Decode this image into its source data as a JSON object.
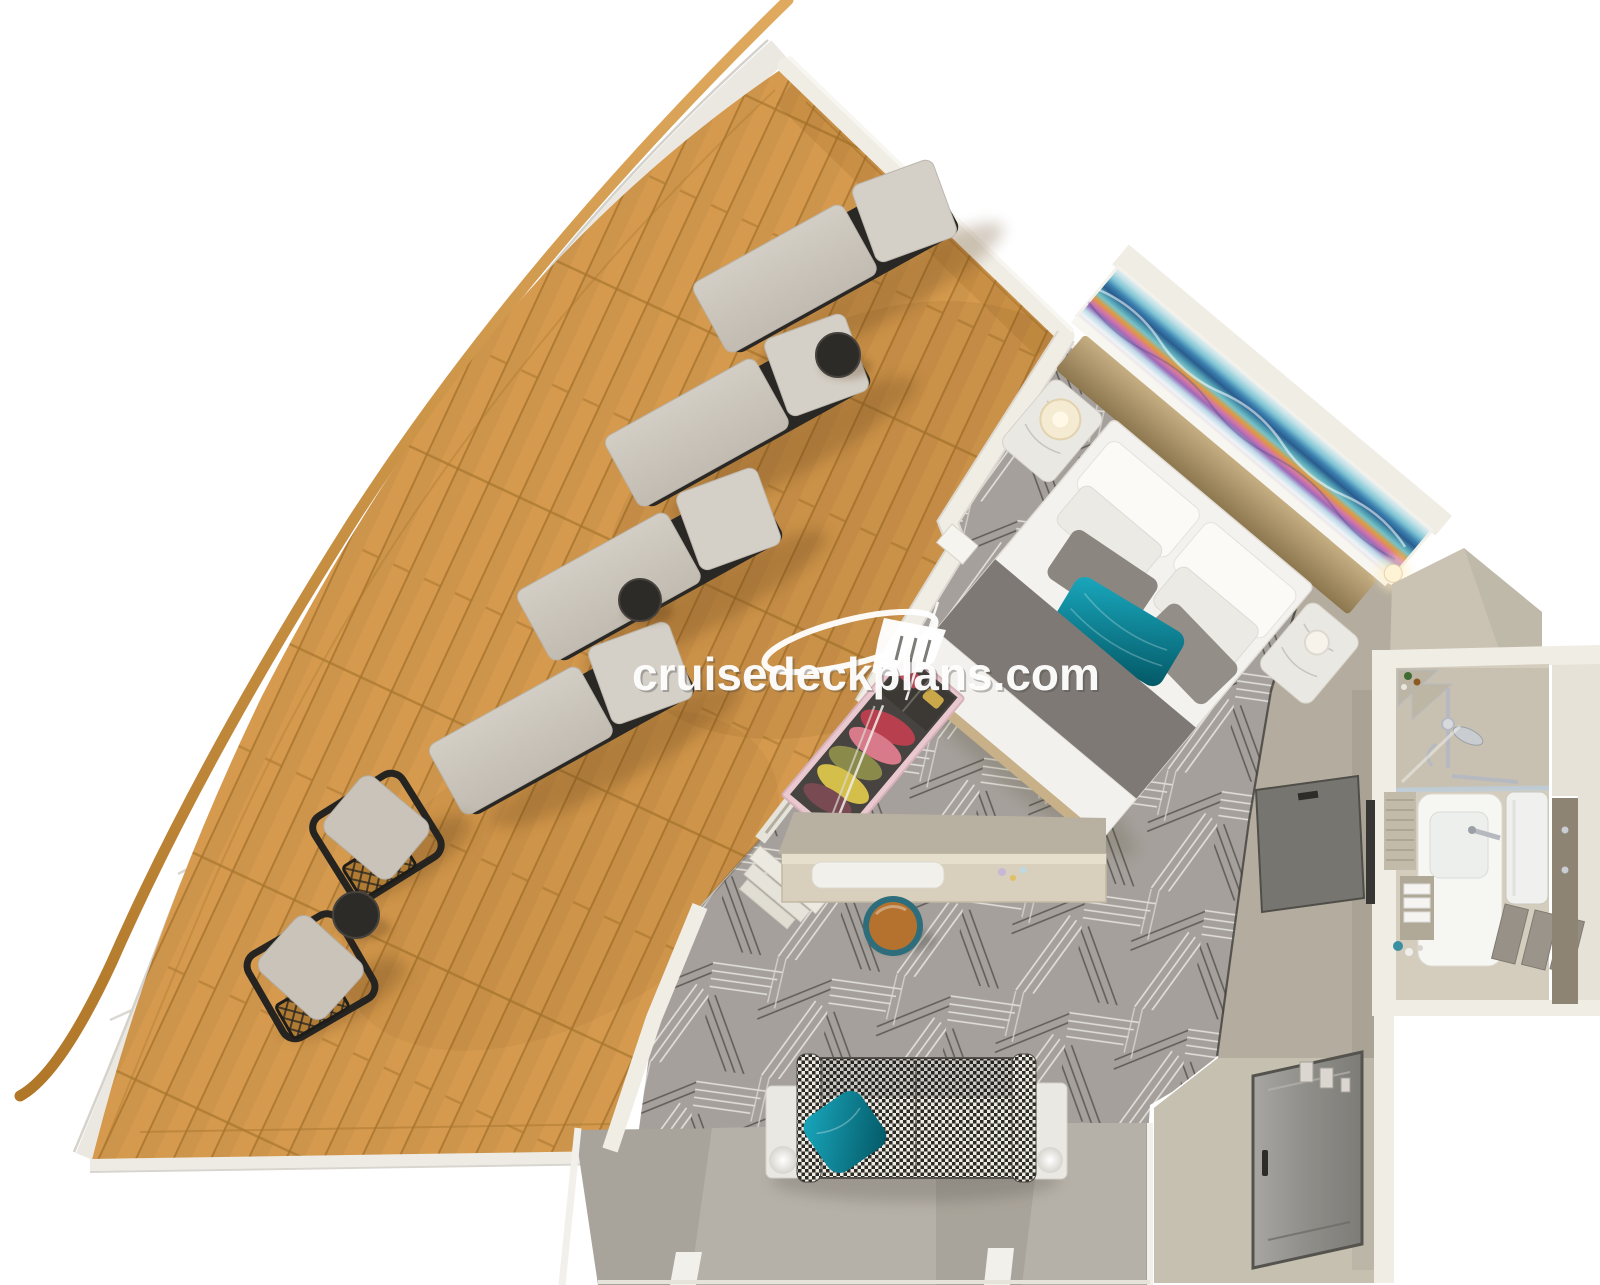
{
  "diagram": {
    "type": "cruise-cabin-3d-floorplan",
    "view": "top-down cutaway render",
    "rooms": [
      {
        "name": "balcony",
        "floor": "teak-plank-deck",
        "furniture": [
          "sun-lounger",
          "sun-lounger",
          "sun-lounger",
          "sun-lounger",
          "round-side-table",
          "round-side-table",
          "rattan-chair",
          "rattan-chair",
          "round-side-table"
        ]
      },
      {
        "name": "bedroom",
        "floor": "geometric-gray-carpet",
        "furniture": [
          "queen-bed",
          "headboard-art-panel",
          "nightstand-with-lamp",
          "nightstand-with-lamp",
          "wall-sconce",
          "open-wardrobe",
          "vanity-desk",
          "round-stool"
        ]
      },
      {
        "name": "sitting-area",
        "floor": "geometric-gray-carpet",
        "furniture": [
          "houndstooth-sofa",
          "teal-accent-pillow",
          "marble-lamp-table",
          "marble-lamp-table"
        ]
      },
      {
        "name": "bathroom",
        "floor": "vinyl",
        "fixtures": [
          "shower",
          "glass-partition",
          "vanity-sink",
          "mirror",
          "louver-cabinet",
          "towel-shelf",
          "towel-rack",
          "tall-cabinet"
        ]
      },
      {
        "name": "entry-hallway",
        "floor": "vinyl",
        "fixtures": [
          "cabin-entry-door",
          "bathroom-sliding-door",
          "light-switches",
          "wall-tv"
        ]
      }
    ]
  },
  "watermark": {
    "text": "cruisedeckplans.com",
    "icon": "cruise-ship-swoosh-icon",
    "color": "#ffffff"
  },
  "palette": {
    "deck_wood": "#d59a4e",
    "deck_seam": "#a9762f",
    "rail_light": "#dfa95e",
    "rail_dark": "#b07728",
    "deck_trim": "#ebe8e2",
    "wall": "#f0ede5",
    "wall_edge": "#d9d5ca",
    "carpet": "#a5a09b",
    "bed_linen": "#f3f2ef",
    "runner": "#7e7974",
    "headboard_tan": "#b59c71",
    "teal": "#0d8a9e",
    "teal_deep": "#065966",
    "lounger_cushion": "#cbc5bc",
    "frame_dark": "#2a2825",
    "marble": "#eae8e3",
    "hall_floor": "#b4ac9e",
    "entry_floor": "#c8c1b2",
    "bath_floor": "#d4cdbe",
    "bath_wall_in": "#c8c1b1",
    "ledge": "#a9a49b",
    "ledge_light": "#b6b1a8",
    "chrome": "#b6bac0",
    "door_gray": "#8b8a85",
    "hound_dark": "#2c2a26",
    "stool_leather": "#b5722f",
    "stool_teal": "#2e6e7c",
    "closet_pink": "#e9c9cf"
  }
}
